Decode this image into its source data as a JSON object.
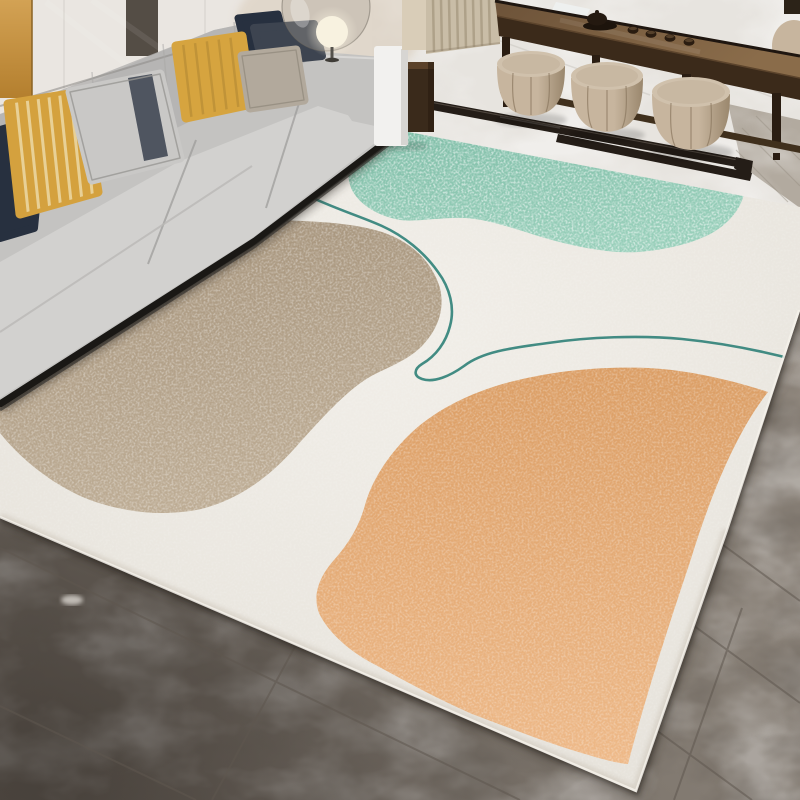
{
  "image_type": "photograph",
  "scene": {
    "setting": "modern living room interior, product photo of an abstract area rug",
    "objects": [
      {
        "name": "sofa",
        "description": "light gray fabric sofa with chaise, dark base trim"
      },
      {
        "name": "throw-pillows",
        "description": "striped gold, mustard, navy, charcoal, gray-banded and taupe pillows"
      },
      {
        "name": "floor-lamp",
        "description": "glowing globe lamp behind sofa armrest"
      },
      {
        "name": "glass-sphere",
        "description": "large smoky glass sphere decor"
      },
      {
        "name": "gold-wall-panel",
        "description": "mustard panel on back wall, far left"
      },
      {
        "name": "curtain",
        "description": "beige pleated curtain"
      },
      {
        "name": "side-table",
        "description": "white side table with dark wood cabinet"
      },
      {
        "name": "console-tea-table",
        "description": "dark walnut console table with black tea set"
      },
      {
        "name": "ottomans",
        "description": "three round beige leather drum ottomans tucked under the console"
      },
      {
        "name": "area-rug",
        "description": "cream abstract rug with speckled green, tan and orange organic blobs and a thin teal contour line"
      },
      {
        "name": "marble-walkway",
        "description": "white marble floor band with dark stone inlay strips"
      },
      {
        "name": "tile-floor",
        "description": "warm gray marble tile floor with diagonal grout lines"
      }
    ]
  },
  "rug": {
    "style": "abstract color-block",
    "elements": [
      "cream-field",
      "green-speckled-blob",
      "tan-blob",
      "orange-blob",
      "teal-contour-line"
    ]
  },
  "palette": {
    "wall": "#eae6e1",
    "wallGoldA": "#d3a254",
    "wallGoldB": "#b47f2e",
    "wallSlab": "#474037",
    "wallSeam": "#d8d4cf",
    "walkway": "#e7e4df",
    "walkwayVein": "#c9c5bf",
    "mosaic": "#b2aa9f",
    "inlay": "#241d17",
    "inlayHi": "#6f665c",
    "floorLight": "#9a9187",
    "floorMid": "#837b72",
    "floorDark": "#675f58",
    "grout": "#5f574f",
    "rugCreamA": "#f1eee8",
    "rugCreamB": "#e5e1d9",
    "rugGreenA": "#7fbda7",
    "rugGreenB": "#98cfba",
    "rugTanA": "#a6947c",
    "rugTanB": "#bdac94",
    "rugOrangeA": "#db9e65",
    "rugOrangeB": "#eeb988",
    "teal": "#2f8178",
    "sofa": "#c4c3c1",
    "sofaBack": "#b3b2b0",
    "sofaSeat": "#d2d1cf",
    "sofaDark": "#1a1815",
    "sofaSeam": "#9b9a98",
    "pillowNavy": "#27303f",
    "pillowNavyStripe": "#39465c",
    "pillowGold": "#d4a13e",
    "pillowGoldStripe": "#ecd9a6",
    "pillowGray": "#c9c8c6",
    "pillowBand": "#4f5560",
    "pillowMustard": "#d6a43f",
    "pillowCharcoal": "#3d4450",
    "pillowTaupe": "#b2a99c",
    "wood": "#40301d",
    "woodTopA": "#6d5339",
    "woodTopB": "#8a6c4a",
    "woodFace": "#3b2a1a",
    "woodDark": "#2a1d12",
    "woodEdge": "#1f1610",
    "pouf": "#c7b59e",
    "poufShade": "#9a876d",
    "poufTop": "#d0c1ac",
    "poufSeam": "#8a775f",
    "curtain": "#c9bda7",
    "curtainShade": "#a4967d",
    "wallBeige": "#d9cdb8",
    "sideTable": "#f2f1ef",
    "sideTableShade": "#d7d5d2",
    "cabinet": "#3a2a1b",
    "cabinetTop": "#5a4129",
    "lampGlow": "#f8f2e0",
    "lampPole": "#55524c",
    "glass": "#a8a094"
  }
}
